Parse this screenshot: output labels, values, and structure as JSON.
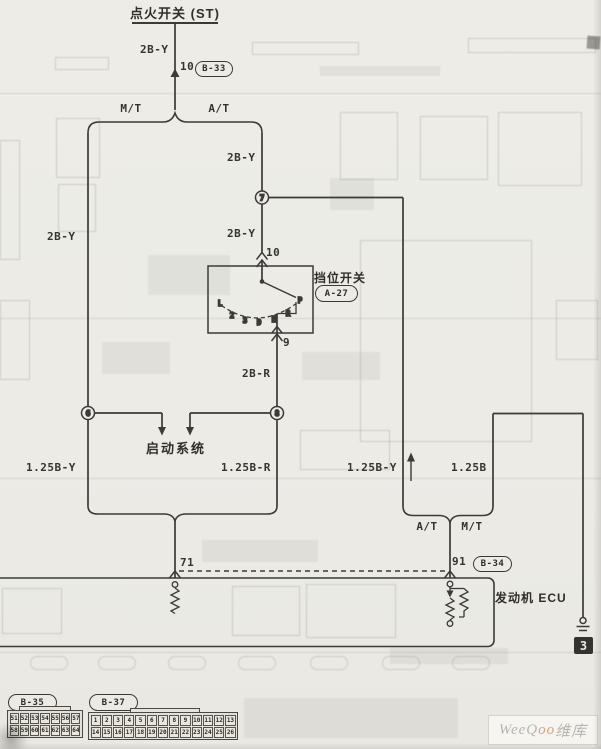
{
  "header": {
    "ignition_switch": "点火开关 (ST)"
  },
  "wire_labels": {
    "ign_2by": "2B-Y",
    "at_upper_2by": "2B-Y",
    "left_2by": "2B-Y",
    "at_lower_2by": "2B-Y",
    "switch_out_2br": "2B-R",
    "left_125by": "1.25B-Y",
    "mid_125br": "1.25B-R",
    "right_125by": "1.25B-Y",
    "right_125b": "1.25B"
  },
  "pins": {
    "ign_pin": "10",
    "switch_in_pin": "10",
    "switch_out_pin": "9",
    "ecu_left_pin": "71",
    "ecu_right_pin": "91"
  },
  "connector_refs": {
    "b33": "B-33",
    "a27": "A-27",
    "b34": "B-34"
  },
  "transmission": {
    "mt_top": "M/T",
    "at_top": "A/T",
    "at_bottom": "A/T",
    "mt_bottom": "M/T"
  },
  "components": {
    "gear_switch": "挡位开关",
    "start_system": "启动系统",
    "engine_ecu": "发动机 ECU"
  },
  "splices": {
    "top": "7",
    "left": "6",
    "right": "8"
  },
  "ground": {
    "ref": "3"
  },
  "gear_positions": [
    "L",
    "2",
    "3",
    "D",
    "N",
    "R",
    "P"
  ],
  "connector_b35": {
    "label": "B-35",
    "row1": [
      "51",
      "52",
      "53",
      "54",
      "55",
      "56",
      "57"
    ],
    "row2": [
      "58",
      "59",
      "60",
      "61",
      "62",
      "63",
      "64"
    ]
  },
  "connector_b37": {
    "label": "B-37",
    "row1": [
      "1",
      "2",
      "3",
      "4",
      "5",
      "6",
      "7",
      "8",
      "9",
      "10",
      "11",
      "12",
      "13"
    ],
    "row2": [
      "14",
      "15",
      "16",
      "17",
      "18",
      "19",
      "20",
      "21",
      "22",
      "23",
      "24",
      "25",
      "26"
    ]
  },
  "watermark": {
    "latin": "WeeQ",
    "oo": "oo",
    "cn": "维库"
  },
  "colors": {
    "ink": "#3b3a38",
    "paper": "#ecebe6",
    "watermark_accent": "#dfa080"
  }
}
